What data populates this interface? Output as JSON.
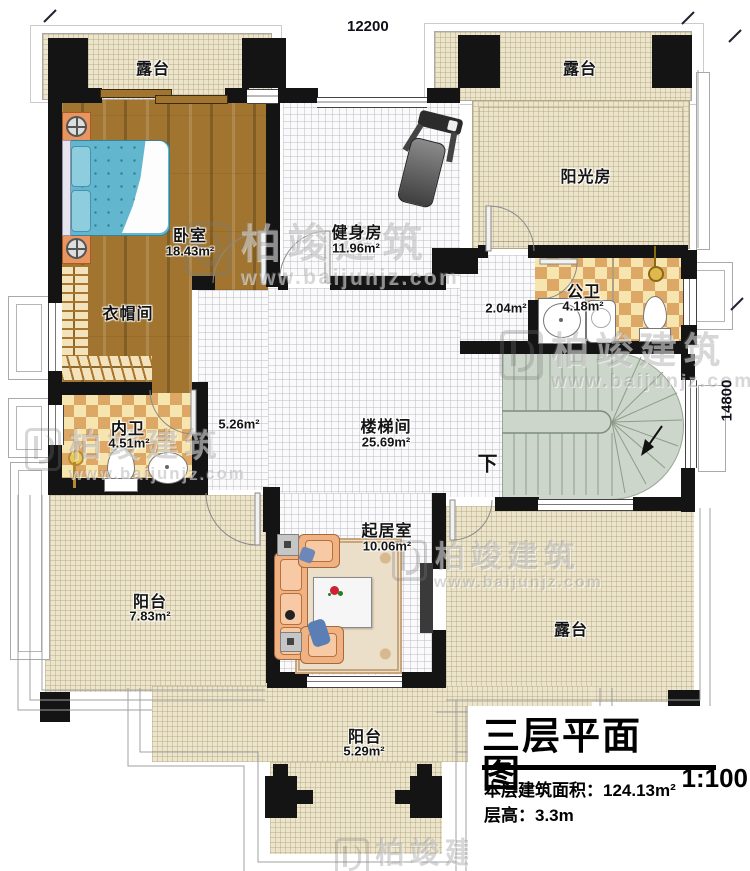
{
  "dimensions": {
    "top_width": "12200",
    "right_height": "14800"
  },
  "rooms": {
    "terrace_top_left": {
      "name": "露台"
    },
    "terrace_top_right": {
      "name": "露台"
    },
    "bedroom": {
      "name": "卧室",
      "area": "18.43m²"
    },
    "gym": {
      "name": "健身房",
      "area": "11.96m²"
    },
    "sunroom": {
      "name": "阳光房"
    },
    "public_bath": {
      "name": "公卫",
      "area": "4.18m²"
    },
    "vestibule": {
      "area": "2.04m²"
    },
    "cloakroom": {
      "name": "衣帽间"
    },
    "ensuite_bath": {
      "name": "内卫",
      "area": "4.51m²"
    },
    "hallway": {
      "area": "5.26m²"
    },
    "stair_hall": {
      "name": "楼梯间",
      "area": "25.69m²"
    },
    "stairs": {
      "direction": "下"
    },
    "living_room": {
      "name": "起居室",
      "area": "10.06m²"
    },
    "balcony_left": {
      "name": "阳台",
      "area": "7.83m²"
    },
    "terrace_bottom_right": {
      "name": "露台"
    },
    "balcony_bottom": {
      "name": "阳台",
      "area": "5.29m²"
    }
  },
  "title_block": {
    "title": "三层平面图",
    "scale": "1:100",
    "floor_area_label": "本层建筑面积：",
    "floor_area_value": "124.13m²",
    "floor_height_label": "层高：",
    "floor_height_value": "3.3m"
  },
  "watermark": {
    "brand": "柏竣建筑",
    "website": "www.baijunjz.com"
  }
}
